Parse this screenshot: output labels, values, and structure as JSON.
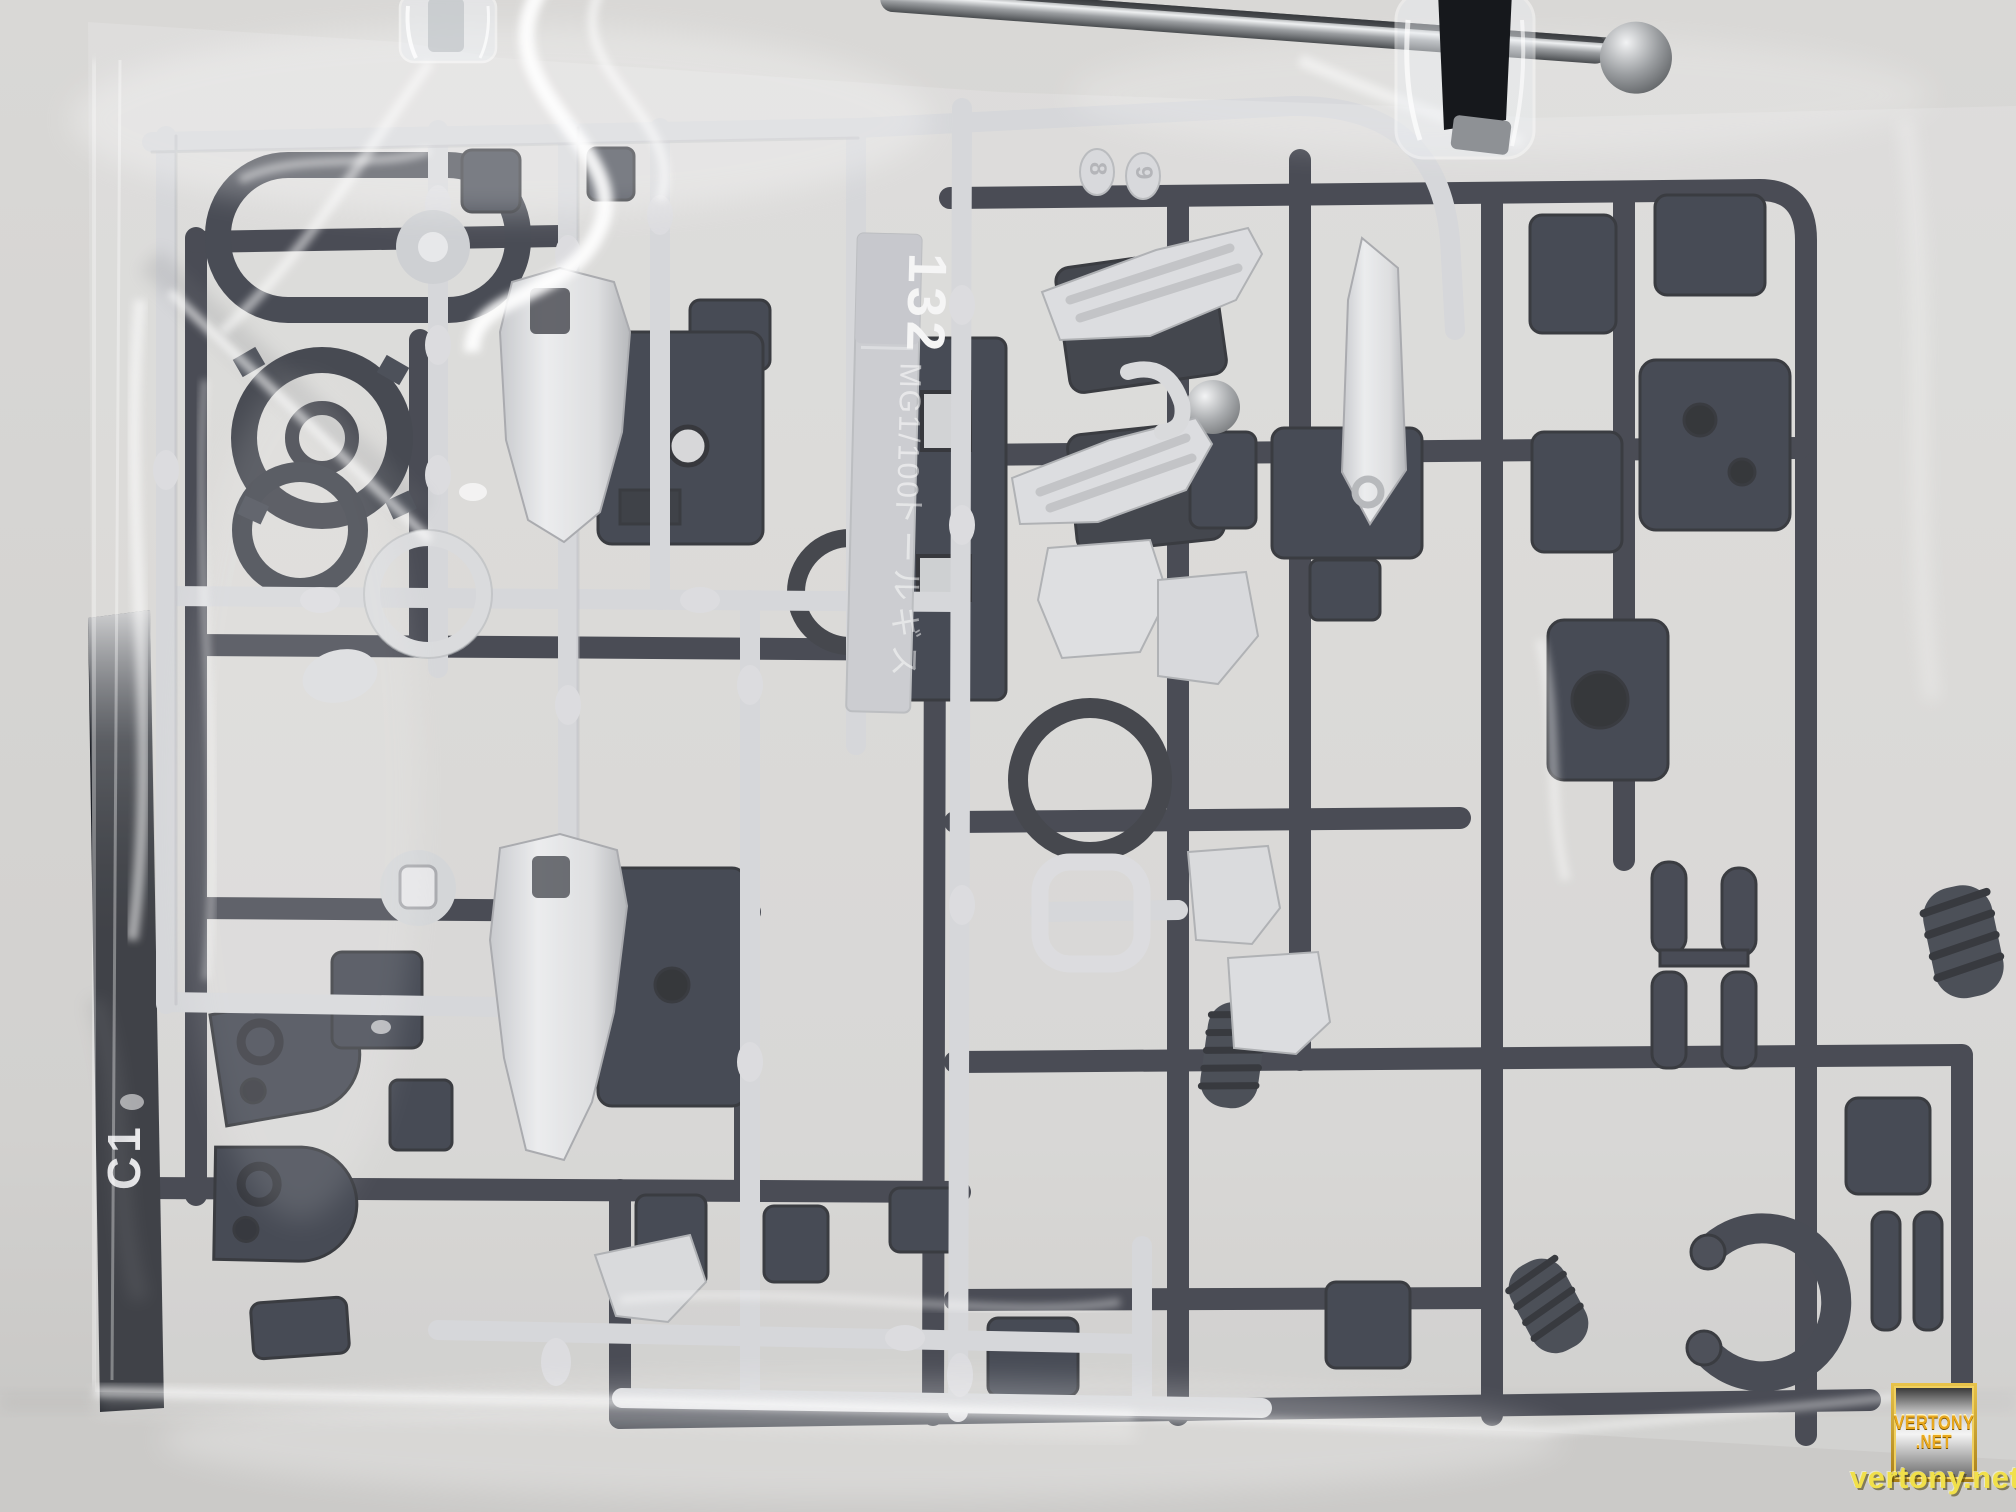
{
  "scene": {
    "alt": "Two model-kit runner sprues (one light gray, one dark navy) sealed in a clear plastic bag, hanging from a metal clip hanger against a gray wall"
  },
  "runner_tag": {
    "kit_number": "132",
    "scale_text": "MG1/100",
    "kit_name_jp": "トールギス"
  },
  "runner_marks": {
    "gate_label": "C1",
    "part_number_tabs": [
      "8",
      "9"
    ]
  },
  "watermark": {
    "badge_top": "VERTONY",
    "badge_bottom": ".NET",
    "url": "vertony.net"
  },
  "colors": {
    "wall": "#d6d5d3",
    "wall_shadow": "#c3c2c0",
    "bag_sheen": "#ffffff",
    "light_runner": "#d3d4d7",
    "light_runner_shadow": "#a9abaf",
    "dark_runner": "#242834",
    "dark_runner_deep": "#13151b",
    "tag_plate": "#c3c5c9",
    "metal": "#aeb1b4",
    "watermark_gold": "#dfa62e",
    "watermark_yellow": "#f2e24d"
  }
}
